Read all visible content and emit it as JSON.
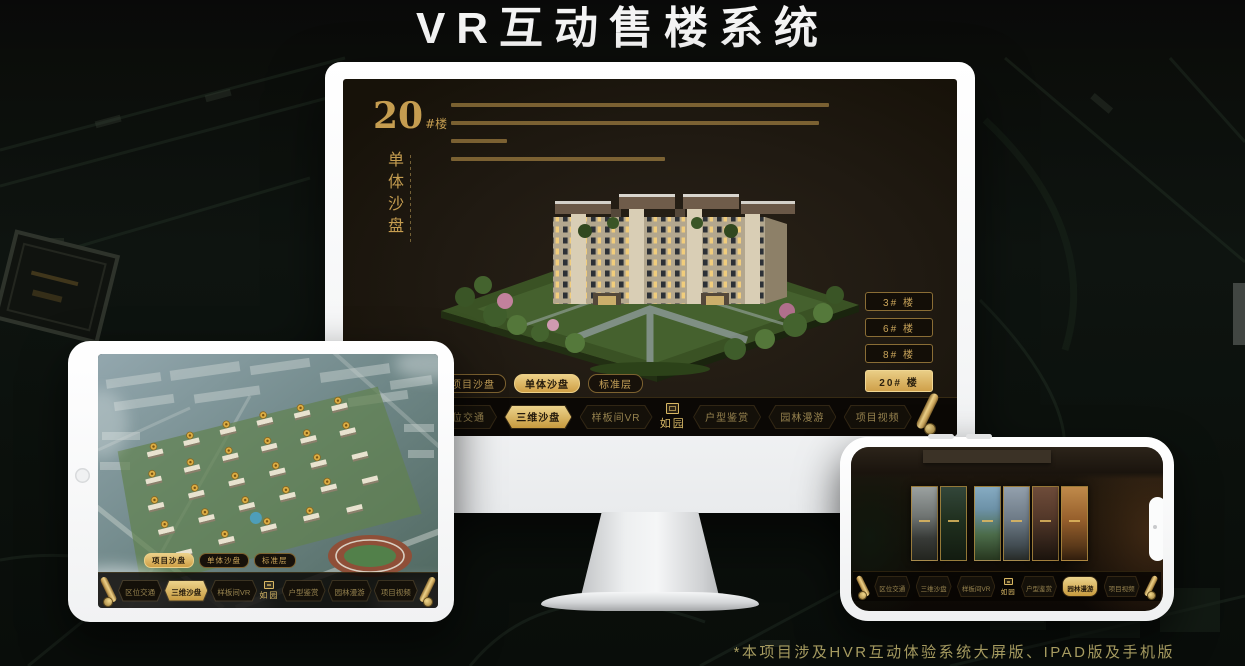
{
  "page": {
    "title": "VR互动售楼系统",
    "footnote": "*本项目涉及HVR互动体验系统大屏版、IPAD版及手机版"
  },
  "brand": {
    "logo": "如园"
  },
  "colors": {
    "gold": "#c9a45a",
    "gold_bright": "#ecd088",
    "active_button_bg": "#cf9f45",
    "monitor_screen_bg": "#201a12",
    "footnote_text": "#a69b60",
    "title_text": "#f4f4f4"
  },
  "monitor": {
    "heading": {
      "number": "20",
      "suffix": "#楼",
      "vertical": "单体沙盘"
    },
    "building_buttons": [
      {
        "label": "3# 楼",
        "active": false
      },
      {
        "label": "6# 楼",
        "active": false
      },
      {
        "label": "8# 楼",
        "active": false
      },
      {
        "label": "20# 楼",
        "active": true
      }
    ],
    "view_tabs": [
      {
        "label": "项目沙盘",
        "active": false
      },
      {
        "label": "单体沙盘",
        "active": true
      },
      {
        "label": "标准层",
        "active": false
      }
    ],
    "menu": [
      {
        "label": "区位交通",
        "active": false
      },
      {
        "label": "三维沙盘",
        "active": true
      },
      {
        "label": "样板间VR",
        "active": false
      },
      {
        "label": "户型鉴赏",
        "active": false
      },
      {
        "label": "园林漫游",
        "active": false
      },
      {
        "label": "项目视频",
        "active": false
      }
    ]
  },
  "tablet": {
    "view_tabs": [
      {
        "label": "项目沙盘",
        "active": true
      },
      {
        "label": "单体沙盘",
        "active": false
      },
      {
        "label": "标准层",
        "active": false
      }
    ],
    "menu": [
      {
        "label": "区位交通",
        "active": false
      },
      {
        "label": "三维沙盘",
        "active": true
      },
      {
        "label": "样板间VR",
        "active": false
      },
      {
        "label": "户型鉴赏",
        "active": false
      },
      {
        "label": "园林漫游",
        "active": false
      },
      {
        "label": "项目视频",
        "active": false
      }
    ]
  },
  "phone": {
    "menu": [
      {
        "label": "区位交通",
        "active": false
      },
      {
        "label": "三维沙盘",
        "active": false
      },
      {
        "label": "样板间VR",
        "active": false
      },
      {
        "label": "户型鉴赏",
        "active": false
      },
      {
        "label": "园林漫游",
        "active": true
      },
      {
        "label": "项目视频",
        "active": false
      }
    ]
  }
}
